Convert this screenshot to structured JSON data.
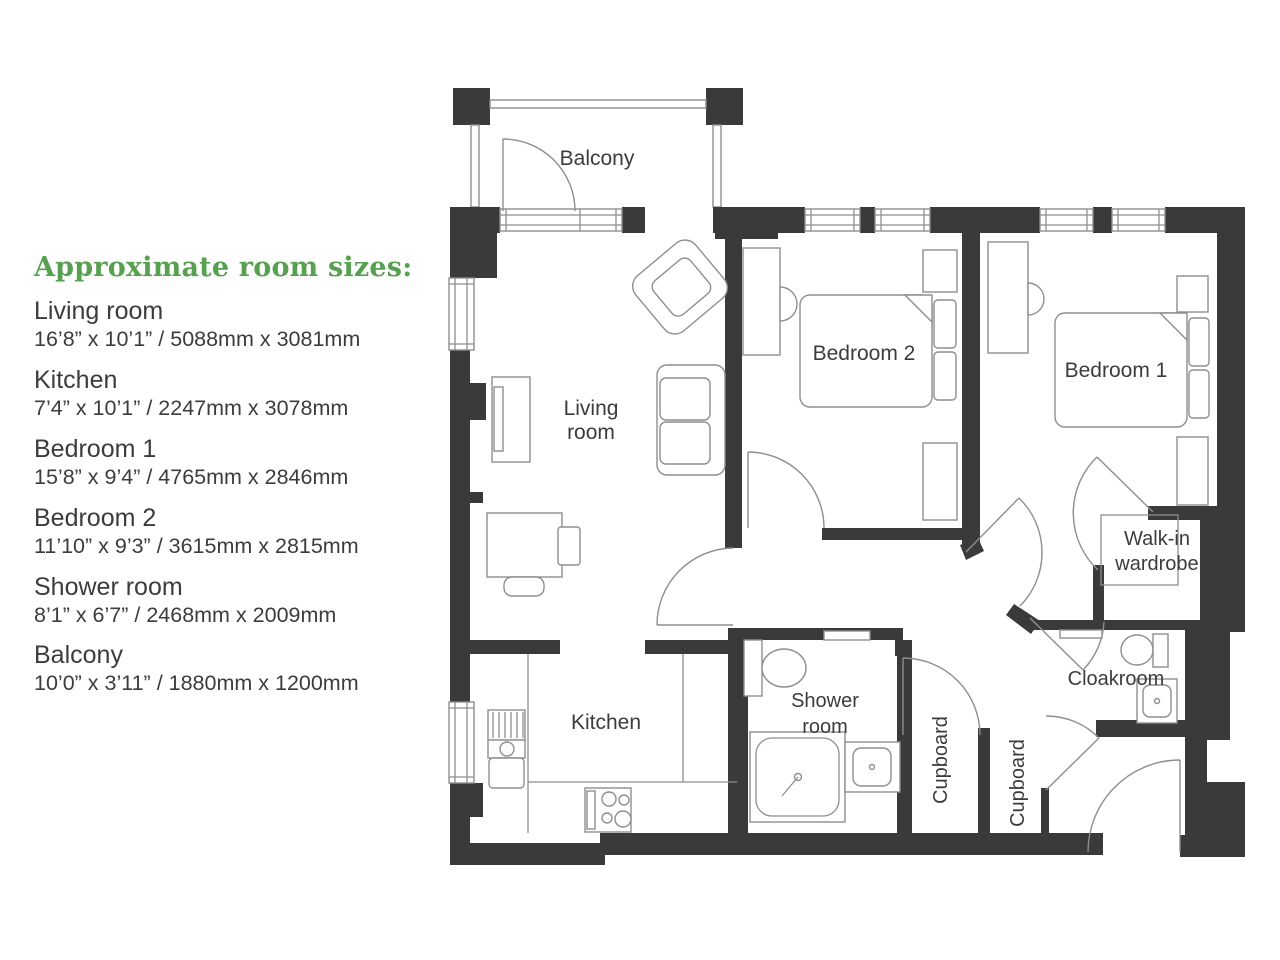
{
  "colors": {
    "wall": "#3a3a3a",
    "furniture_line": "#8e8e8e",
    "text": "#3c3c3c",
    "heading_green": "#57a04f",
    "background": "#ffffff"
  },
  "sizes_panel": {
    "heading": "Approximate room sizes:",
    "rooms": [
      {
        "name": "Living room",
        "dims": "16’8” x 10’1” / 5088mm x 3081mm"
      },
      {
        "name": "Kitchen",
        "dims": "7’4” x 10’1” / 2247mm x 3078mm"
      },
      {
        "name": "Bedroom 1",
        "dims": "15’8” x 9’4” / 4765mm x 2846mm"
      },
      {
        "name": "Bedroom 2",
        "dims": "11’10” x 9’3” / 3615mm x 2815mm"
      },
      {
        "name": "Shower room",
        "dims": "8’1” x 6’7” / 2468mm x 2009mm"
      },
      {
        "name": "Balcony",
        "dims": "10’0” x 3’11” / 1880mm x 1200mm"
      }
    ]
  },
  "floorplan": {
    "labels": {
      "balcony": "Balcony",
      "living_room_line1": "Living",
      "living_room_line2": "room",
      "bedroom2": "Bedroom 2",
      "bedroom1": "Bedroom 1",
      "walk_in_line1": "Walk-in",
      "walk_in_line2": "wardrobe",
      "kitchen": "Kitchen",
      "shower_line1": "Shower",
      "shower_line2": "room",
      "cupboard1": "Cupboard",
      "cupboard2": "Cupboard",
      "cloakroom": "Cloakroom"
    }
  }
}
